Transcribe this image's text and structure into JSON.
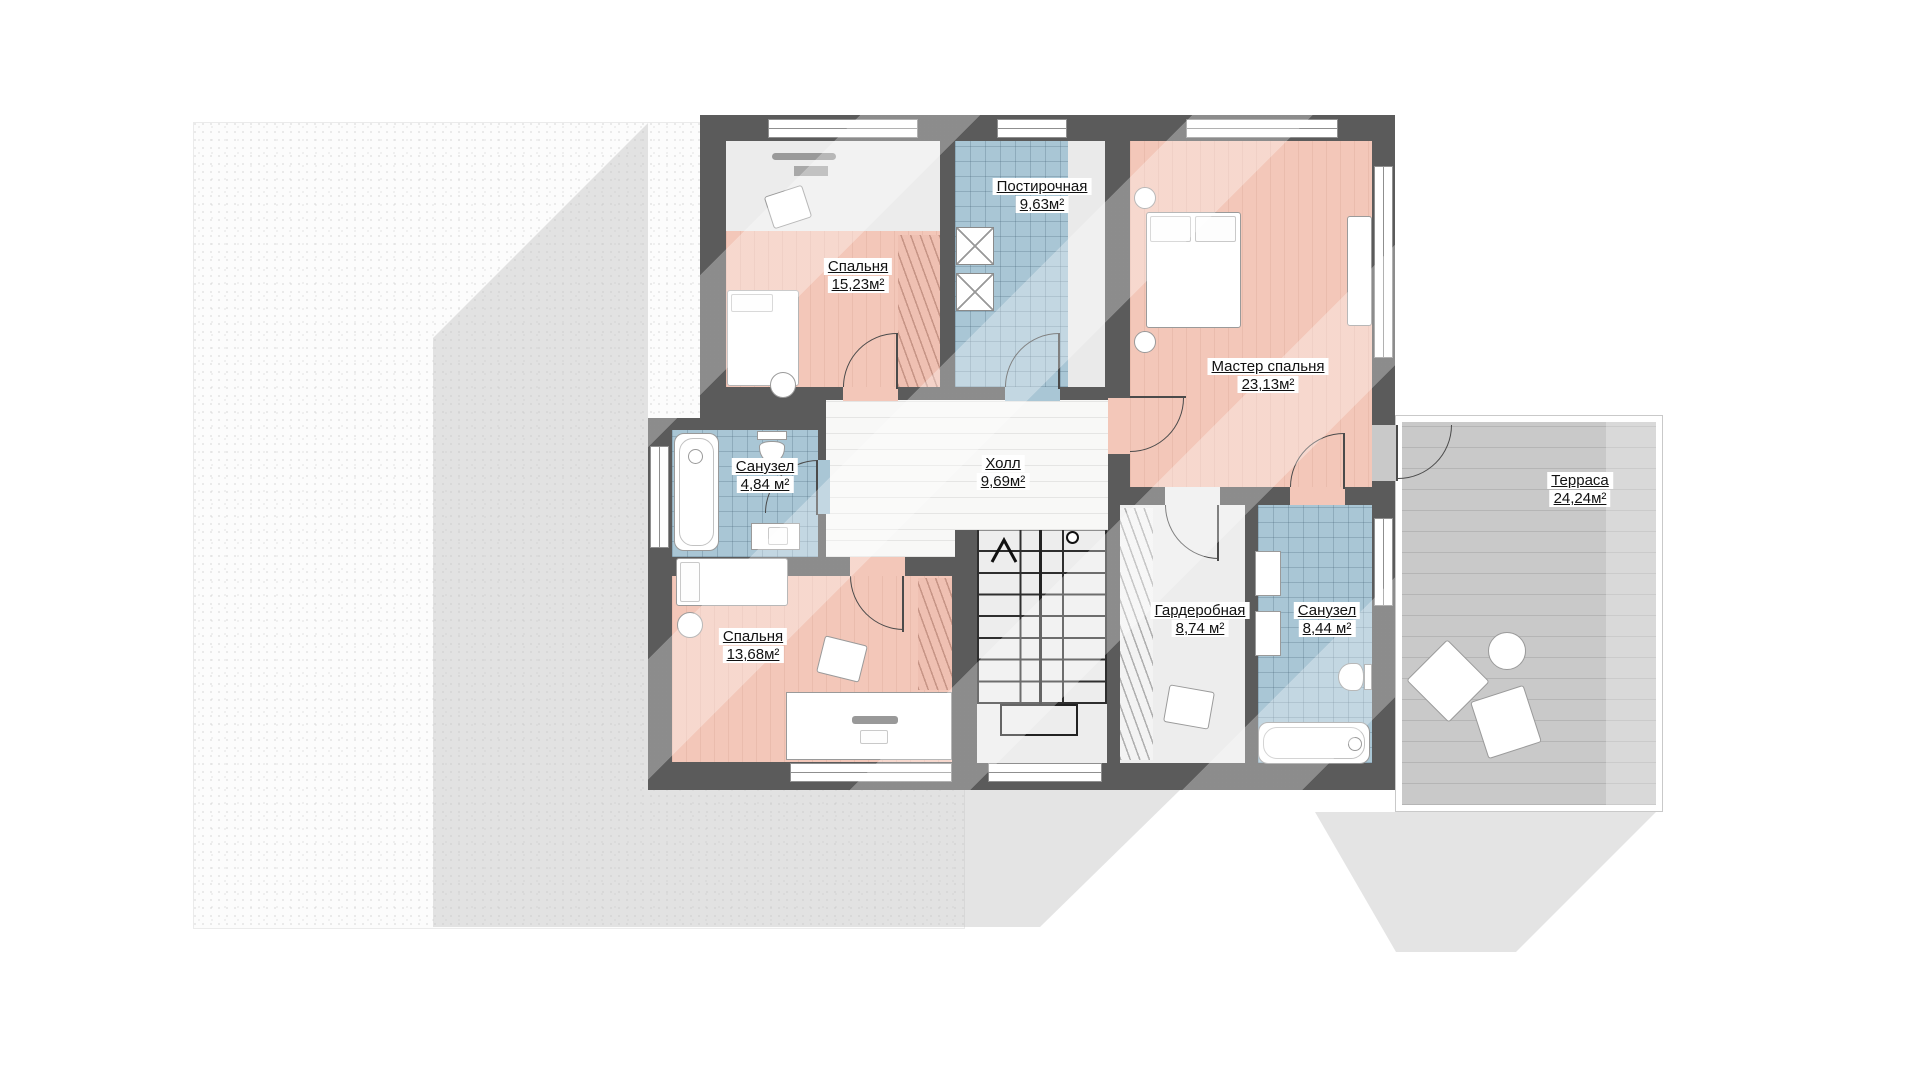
{
  "plan": {
    "rooms": {
      "laundry": {
        "name": "Постирочная",
        "area": "9,63м²"
      },
      "bedroom1": {
        "name": "Спальня",
        "area": "15,23м²"
      },
      "master": {
        "name": "Мастер спальня",
        "area": "23,13м²"
      },
      "bath1": {
        "name": "Санузел",
        "area": "4,84 м²"
      },
      "hall": {
        "name": "Холл",
        "area": "9,69м²"
      },
      "bedroom2": {
        "name": "Спальня",
        "area": "13,68м²"
      },
      "wardrobe": {
        "name": "Гардеробная",
        "area": "8,74 м²"
      },
      "bath2": {
        "name": "Санузел",
        "area": "8,44 м²"
      },
      "terrace": {
        "name": "Терраса",
        "area": "24,24м²"
      }
    },
    "colors": {
      "wall": "#5b5b5b",
      "bedroom_floor": "#f3c7b9",
      "tile_floor": "#a9c6d5",
      "hall_floor": "#f8f8f7",
      "wardrobe_floor": "#ededed",
      "terrace_floor": "#c9c9c9",
      "yard": "#fcfcfc",
      "shadow": "#e9e9e9"
    }
  }
}
